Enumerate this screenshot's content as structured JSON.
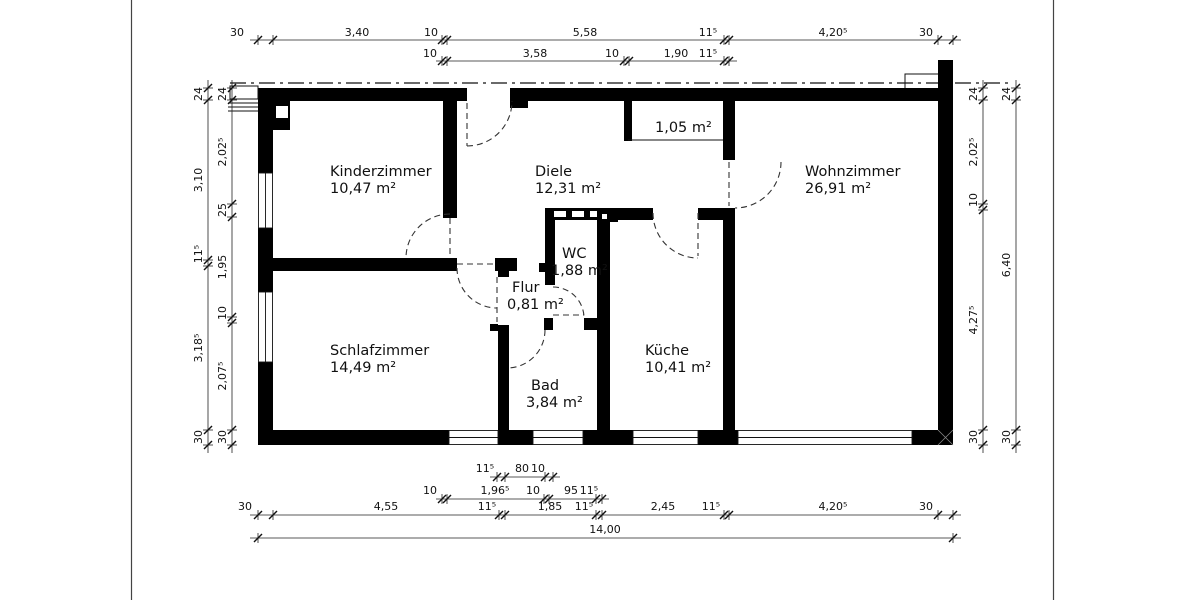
{
  "rooms": {
    "kinderzimmer": {
      "name": "Kinderzimmer",
      "area": "10,47 m²"
    },
    "diele": {
      "name": "Diele",
      "area": "12,31 m²"
    },
    "wohnzimmer": {
      "name": "Wohnzimmer",
      "area": "26,91 m²"
    },
    "schlafzimmer": {
      "name": "Schlafzimmer",
      "area": "14,49 m²"
    },
    "wc": {
      "name": "WC",
      "area": "1,88 m²"
    },
    "flur": {
      "name": "Flur",
      "area": "0,81 m²"
    },
    "bad": {
      "name": "Bad",
      "area": "3,84 m²"
    },
    "kueche": {
      "name": "Küche",
      "area": "10,41 m²"
    },
    "abstell": {
      "area": "1,05 m²"
    }
  },
  "dims": {
    "t1": [
      "30",
      "3,40",
      "10",
      "5,58",
      "11⁵",
      "4,20⁵",
      "30"
    ],
    "t2": [
      "10",
      "3,58",
      "10",
      "1,90",
      "11⁵"
    ],
    "b1": [
      "11⁵",
      "80",
      "10"
    ],
    "b2": [
      "10",
      "1,96⁵",
      "10",
      "95",
      "11⁵"
    ],
    "b3": [
      "30",
      "4,55",
      "11⁵",
      "1,85",
      "11⁵",
      "2,45",
      "11⁵",
      "4,20⁵",
      "30"
    ],
    "b4": [
      "14,00"
    ],
    "l_outer": [
      "24",
      "3,10",
      "11⁵",
      "3,18⁵",
      "30"
    ],
    "l_inner": [
      "24",
      "2,02⁵",
      "25",
      "1,95",
      "10",
      "2,07⁵",
      "30"
    ],
    "r_inner": [
      "24",
      "2,02⁵",
      "10",
      "4,27⁵",
      "30"
    ],
    "r_outer": [
      "24",
      "6,40",
      "30"
    ]
  }
}
